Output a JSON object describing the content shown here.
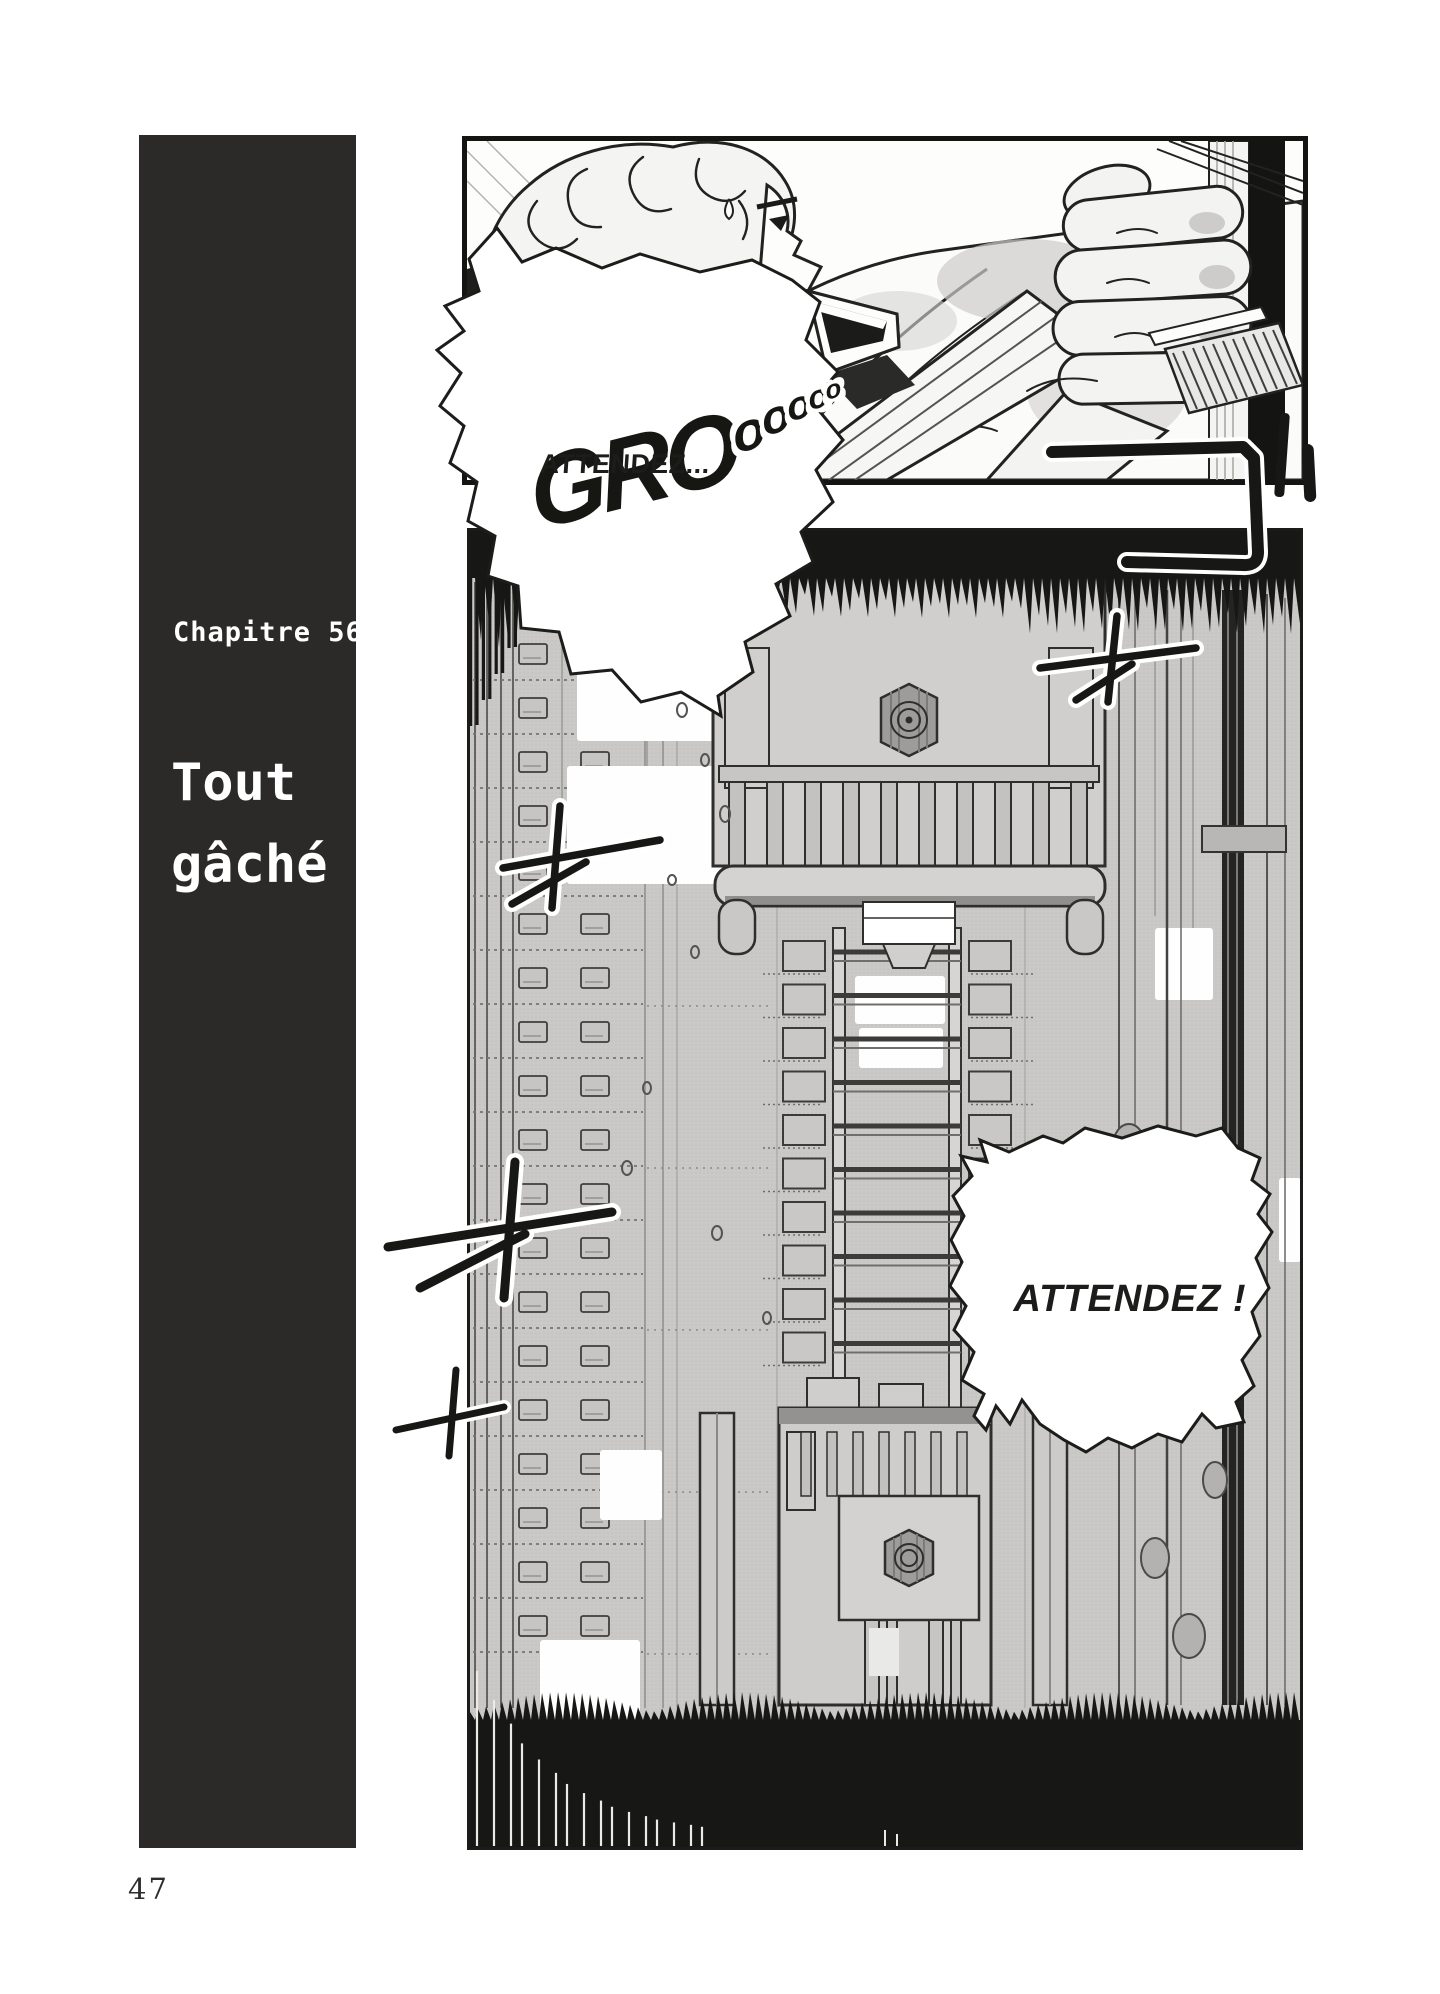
{
  "page": {
    "number": "47"
  },
  "chapter": {
    "label": "Chapitre 56",
    "title_line1": "Tout",
    "title_line2": "gâché"
  },
  "bubbles": {
    "first": "ATTENDEZ...",
    "second": "ATTENDEZ !"
  },
  "sfx": {
    "main": "GRO",
    "trail": "ooooo"
  },
  "colors": {
    "ink": "#1c1c1a",
    "chapter_block": "#2b2a28",
    "panel_gray": "#cac9c7"
  }
}
